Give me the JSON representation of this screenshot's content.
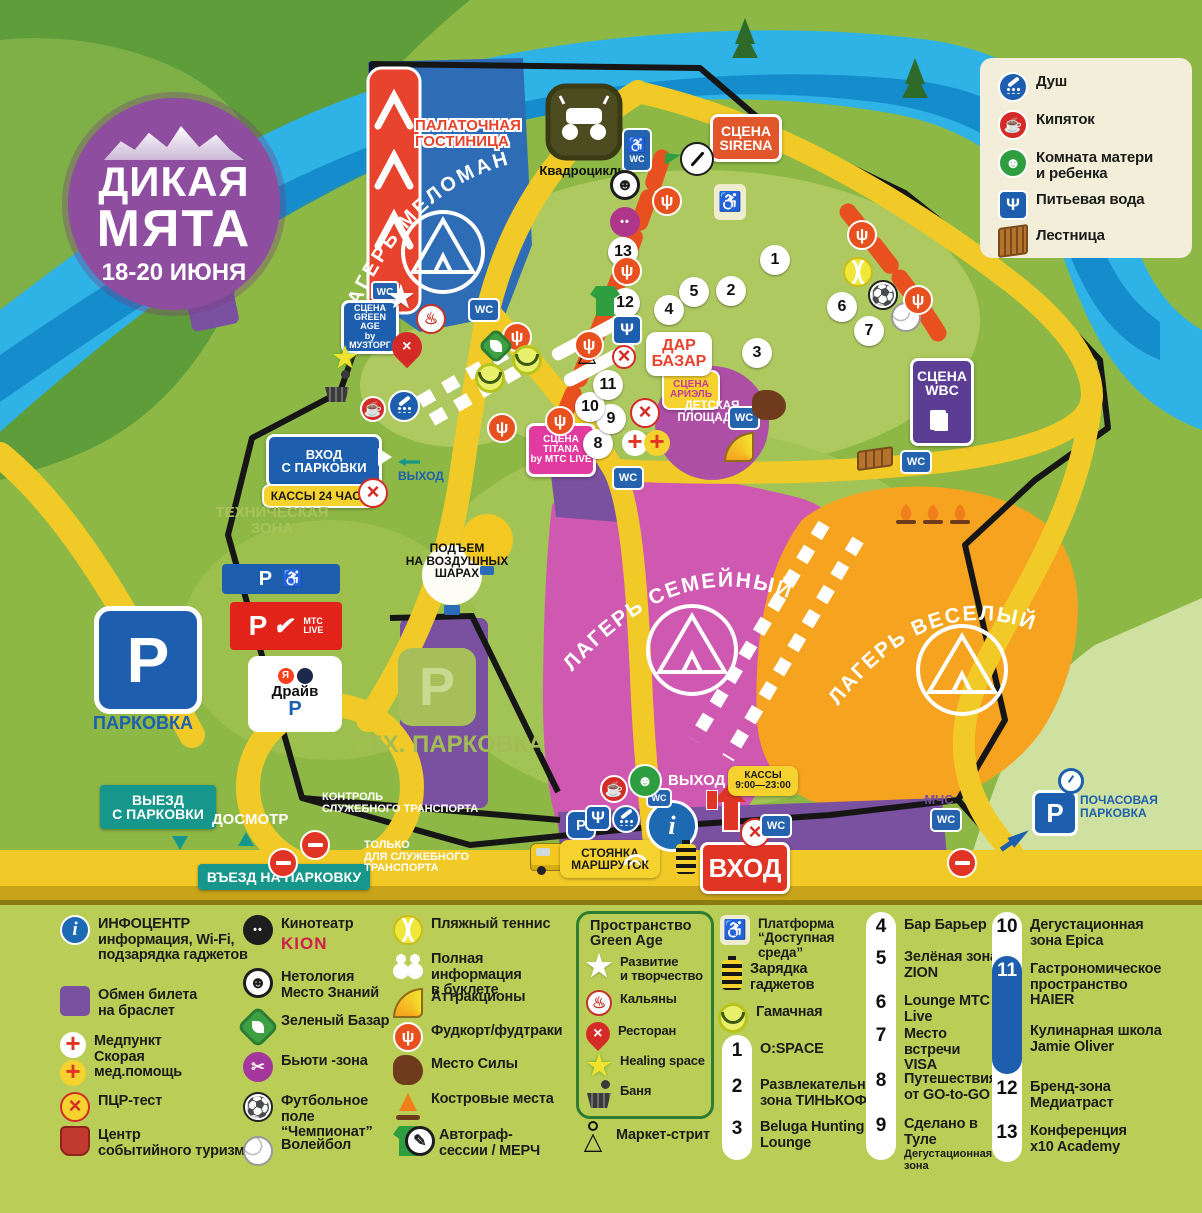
{
  "logo": {
    "line1": "ДИКАЯ",
    "line2": "МЯТА",
    "dates": "18-20 ИЮНЯ"
  },
  "facilities": {
    "items": [
      {
        "icon": "shower-icon",
        "label": "Душ"
      },
      {
        "icon": "boiling-water-icon",
        "label": "Кипяток"
      },
      {
        "icon": "mother-child-room-icon",
        "label": "Комната матери\nи ребенка"
      },
      {
        "icon": "drinking-water-icon",
        "label": "Питьевая вода"
      },
      {
        "icon": "stairs-icon",
        "label": "Лестница"
      }
    ]
  },
  "map": {
    "wc": "WC",
    "p": "P",
    "labels": {
      "tent_hotel": "ПАЛАТОЧНАЯ\nГОСТИНИЦА",
      "camp_meloman": "ЛАГЕРЬ  МЕЛОМАН",
      "camp_family": "ЛАГЕРЬ  СЕМЕЙНЫЙ",
      "camp_vesely": "ЛАГЕРЬ  ВЕСЕЛЫЙ",
      "quad_bikes": "Квадроциклы",
      "stage_sirena": "СЦЕНА\nSIRENA",
      "stage_greenage": "СЦЕНА\nGREEN AGE\nby МУЗТОРГ",
      "stage_titana": "СЦЕНА\nTITANA\nby МТС LIVE",
      "stage_ariel": "СЦЕНА\nАРИЭЛЬ",
      "stage_wbc": "СЦЕНА\nWBC",
      "dar_bazar": "ДАР\nБАЗАР",
      "kids_area": "ДЕТСКАЯ\nПЛОЩАДКА",
      "entrance_parking": "ВХОД\nС ПАРКОВКИ",
      "ticket_24h": "КАССЫ 24 ЧАСА",
      "exit_gate": "ВЫХОД",
      "tech_zone": "ТЕХНИЧЕСКАЯ\nЗОНА",
      "balloons": "ПОДЪЕМ\nНА ВОЗДУШНЫХ\nШАРАХ",
      "parking": "ПАРКОВКА",
      "parking_mts": "МТС\nLIVE",
      "drive_ya": "Я",
      "drive": "Драйв",
      "tech_parking": "ТЕХ. ПАРКОВКА",
      "exit_from_parking": "ВЫЕЗД\nС ПАРКОВКИ",
      "inspection": "ДОСМОТР",
      "entry_to_parking": "ВЪЕЗД НА ПАРКОВКУ",
      "service_control": "КОНТРОЛЬ\nСЛУЖЕБНОГО ТРАНСПОРТА",
      "service_only": "ТОЛЬКО\nДЛЯ СЛУЖЕБНОГО\nТРАНСПОРТА",
      "shuttle_parking": "СТОЯНКА\nМАРШРУТОК",
      "entrance_main": "ВХОД",
      "exit_main": "ВЫХОД",
      "ticket_hours": "КАССЫ\n9:00—23:00",
      "emergency": "МЧС\nМВД",
      "hourly_parking": "ПОЧАСОВАЯ\nПАРКОВКА"
    },
    "markers": [
      "1",
      "2",
      "3",
      "4",
      "5",
      "6",
      "7",
      "8",
      "9",
      "10",
      "11",
      "12",
      "13"
    ]
  },
  "legend": {
    "col1": [
      {
        "icon": "info-icon",
        "label": "ИНФОЦЕНТР\nинформация, Wi-Fi,\nподзарядка гаджетов"
      },
      {
        "icon": "wristband-exchange-icon",
        "label": "Обмен билета\nна браслет"
      },
      {
        "icon": "first-aid-icon",
        "label": "Медпункт\nСкорая\nмед.помощь"
      },
      {
        "icon": "pcr-test-icon",
        "label": "ПЦР-тест"
      },
      {
        "icon": "event-tourism-icon",
        "label": "Центр\nсобытийного туризма"
      }
    ],
    "col2": [
      {
        "icon": "cinema-icon",
        "label": "Кинотеатр",
        "brand": "KION"
      },
      {
        "icon": "netology-icon",
        "label": "Нетология\nМесто Знаний"
      },
      {
        "icon": "green-bazaar-icon",
        "label": "Зеленый Базар"
      },
      {
        "icon": "beauty-zone-icon",
        "label": "Бьюти -зона"
      },
      {
        "icon": "football-icon",
        "label": "Футбольное поле\n“Чемпионат”"
      },
      {
        "icon": "volleyball-icon",
        "label": "Волейбол"
      }
    ],
    "col3": [
      {
        "icon": "beach-tennis-icon",
        "label": "Пляжный теннис"
      },
      {
        "icon": "booklet-info-icon",
        "label": "Полная информация\nв буклете"
      },
      {
        "icon": "attractions-icon",
        "label": "Аттракционы"
      },
      {
        "icon": "foodcourt-icon",
        "label": "Фудкорт/фудтраки"
      },
      {
        "icon": "place-of-power-icon",
        "label": "Место Силы"
      },
      {
        "icon": "campfire-icon",
        "label": "Костровые места"
      },
      {
        "icon": "autograph-merch-icon",
        "label": "Автограф-\nсессии / МЕРЧ"
      }
    ],
    "green_age": {
      "title": "Пространство\nGreen Age",
      "items": [
        {
          "icon": "development-star-icon",
          "label": "Развитие\nи творчество"
        },
        {
          "icon": "hookah-icon",
          "label": "Кальяны"
        },
        {
          "icon": "restaurant-icon",
          "label": "Ресторан"
        },
        {
          "icon": "healing-space-icon",
          "label": "Healing space"
        },
        {
          "icon": "banya-icon",
          "label": "Баня"
        }
      ]
    },
    "market_street": {
      "icon": "hanger-icon",
      "label": "Маркет-стрит"
    },
    "col5": [
      {
        "icon": "accessible-platform-icon",
        "label": "Платформа\n“Доступная среда”"
      },
      {
        "icon": "charging-icon",
        "label": "Зарядка\nгаджетов"
      },
      {
        "icon": "hammock-icon",
        "label": "Гамачная"
      }
    ],
    "nums_a": [
      {
        "num": "1",
        "label": "O:SPACE"
      },
      {
        "num": "2",
        "label": "Развлекательная\nзона ТИНЬКОФФ"
      },
      {
        "num": "3",
        "label": "Beluga Hunting\nLounge"
      }
    ],
    "nums_b": [
      {
        "num": "4",
        "label": "Бар Барьер"
      },
      {
        "num": "5",
        "label": "Зелёная зона\nZION"
      },
      {
        "num": "6",
        "label": "Lounge МТС Live"
      },
      {
        "num": "7",
        "label": "Место встречи\nVISA"
      },
      {
        "num": "8",
        "label": "Путешествия\nот GO-to-GO"
      },
      {
        "num": "9",
        "label": "Сделано в Туле",
        "sub": "Дегустационная зона"
      }
    ],
    "nums_c": [
      {
        "num": "10",
        "label": "Дегустационная\nзона Epica"
      },
      {
        "num": "11",
        "label": "Гастрономическое\nпространство\nHAIER"
      },
      {
        "num": "",
        "label": "Кулинарная школа\nJamie Oliver"
      },
      {
        "num": "12",
        "label": "Бренд-зона\nМедиатраст"
      },
      {
        "num": "13",
        "label": "Конференция\nx10 Academy"
      }
    ]
  },
  "colors": {
    "accent_blue": "#1d5fae",
    "accent_red": "#e03524",
    "accent_teal": "#17968b",
    "camp_pink": "#cf58b1",
    "camp_orange": "#f6a41f",
    "camp_blue": "#2e6cb5",
    "road_yellow": "#f2ca28",
    "river_blue": "#2fb3e6",
    "legend_bg": "#bace57"
  }
}
